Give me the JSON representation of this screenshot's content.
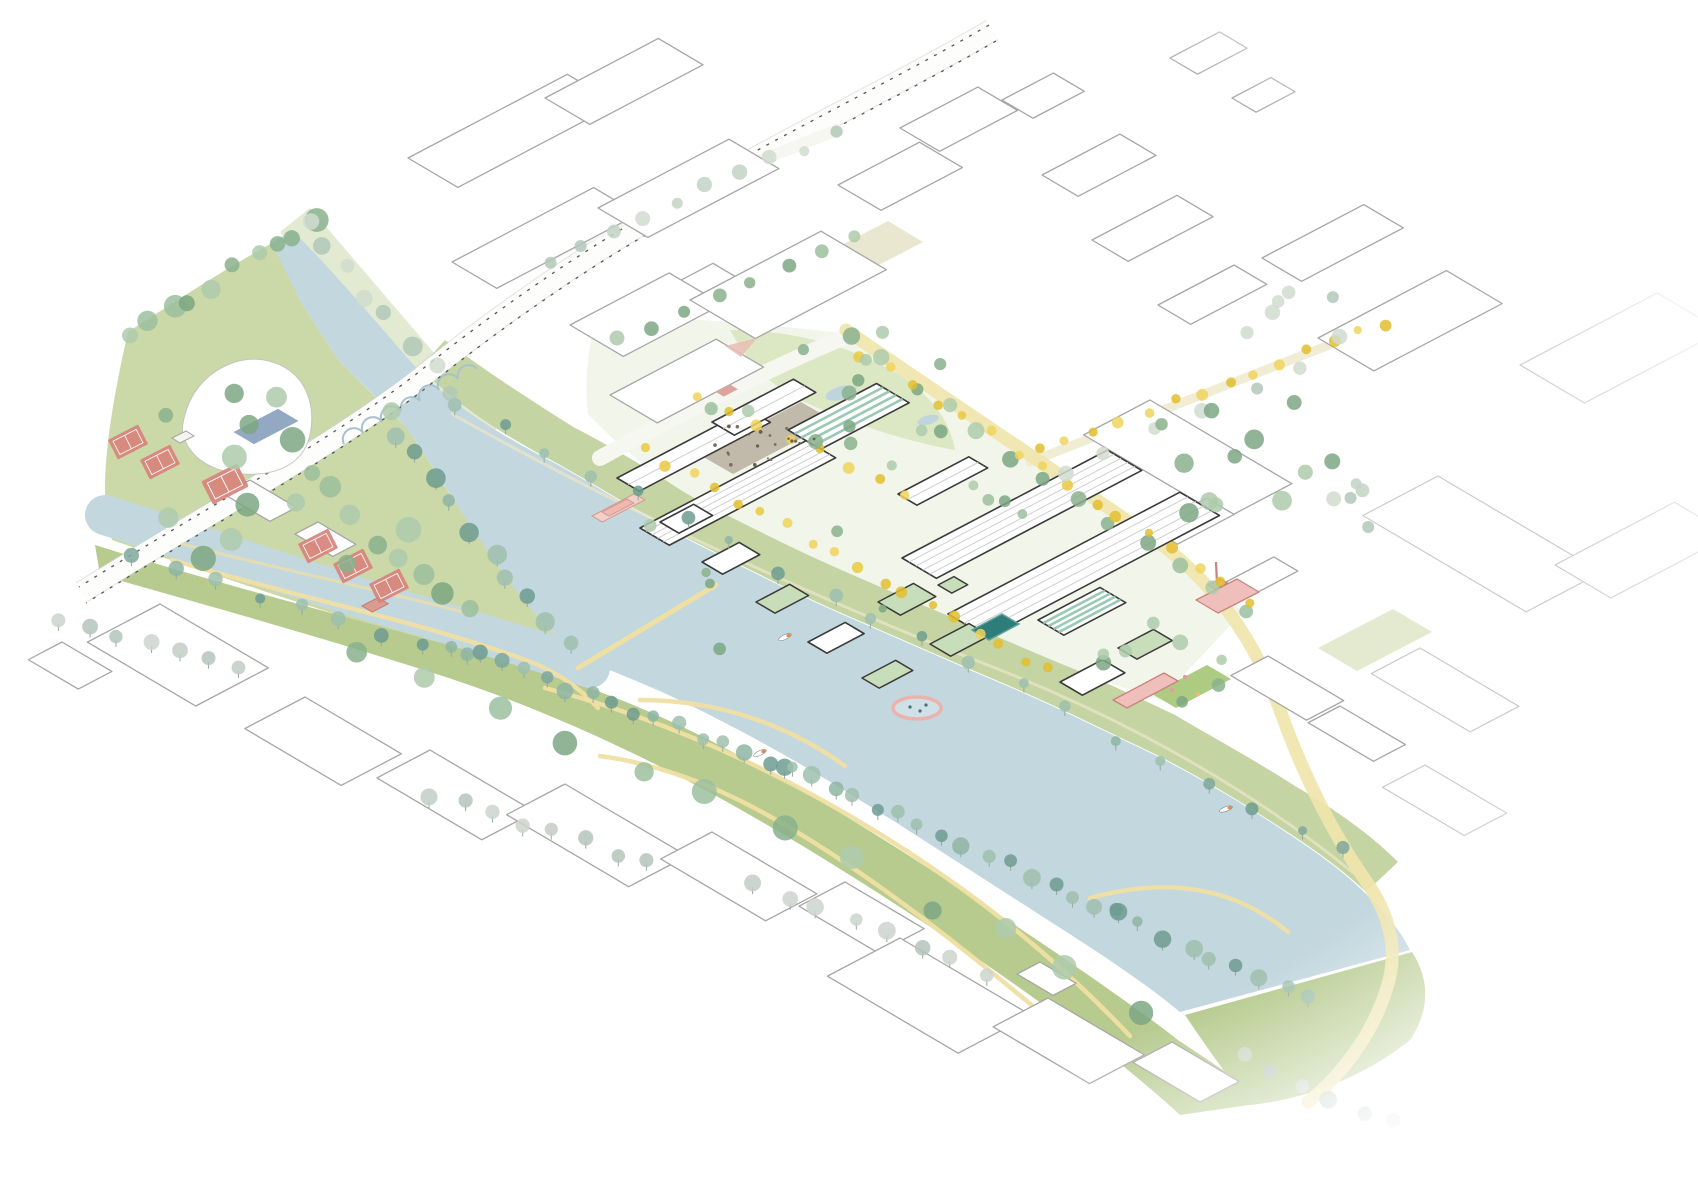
{
  "colors": {
    "river": "#C3D7DF",
    "parkGreen": "#B7CB8F",
    "parkPale": "#E3EAD2",
    "bankGreen": "#C4D4A2",
    "siteGround": "#F2F5E9",
    "northPark": "#DCE7C4",
    "lawn": "#E4EAD0",
    "field": "#E9E7CF",
    "playground": "#AECB82",
    "pathYellow": "#EFDFA3",
    "roadYellow": "#F0E5AC",
    "streetPale": "#F6F7F0",
    "courtRed": "#D8837B",
    "courtLine": "#FFFFFF",
    "pinkFill": "#EFC0BB",
    "pinkLine": "#C9837D",
    "redRoof": "#DC9B90",
    "pool": "#2E7D7A",
    "lidoPool": "#93A8C2",
    "plaza": "#B8AE9E",
    "outline": "#A6A6A6",
    "outlineFaded": "#CBCBCB",
    "siteOutline": "#3A3A3A",
    "roofGreen": "#C8DDB9",
    "ghStripe": "#8FC3AC",
    "railDash": "#555555",
    "railEdge": "#C7CFD2",
    "arcBlue": "#A9C2CE",
    "trunk": "#97A8A0",
    "swimRing": "#EBB3AC",
    "pondBlue": "#BFD5DD"
  },
  "scene": {
    "palettes": {
      "green": [
        "#9CBF9E",
        "#8AB18D",
        "#AECBAB",
        "#7CA783"
      ],
      "bank": [
        "#7FA79B",
        "#8FB5A5",
        "#9FC0AE",
        "#6E9C90"
      ],
      "gray": [
        "#C2CEC6",
        "#B4C4BB",
        "#CBD5CD"
      ],
      "pale": [
        "#C3D4C6",
        "#B2C8B8",
        "#D0DCCF"
      ],
      "yellow": [
        "#EAC93F",
        "#F0D45C",
        "#E3BE2F"
      ],
      "dots": [
        "#6B5F4E",
        "#7A6E5C"
      ]
    },
    "blocks": [
      [
        "c",
        408,
        158,
        180,
        58,
        0
      ],
      [
        "c",
        545,
        98,
        128,
        52,
        0
      ],
      [
        "c",
        452,
        262,
        160,
        52,
        0
      ],
      [
        "c",
        598,
        208,
        148,
        58,
        0
      ],
      [
        "c",
        628,
        308,
        96,
        44,
        0
      ],
      [
        "c",
        570,
        325,
        112,
        62,
        0
      ],
      [
        "c",
        690,
        300,
        148,
        76,
        0
      ],
      [
        "c",
        610,
        395,
        120,
        55,
        0
      ],
      [
        "c",
        838,
        185,
        92,
        50,
        0
      ],
      [
        "c",
        900,
        128,
        88,
        46,
        0
      ],
      [
        "c",
        1002,
        100,
        58,
        36,
        0
      ],
      [
        "c",
        1042,
        175,
        88,
        42,
        0
      ],
      [
        "c",
        1092,
        240,
        96,
        42,
        0
      ],
      [
        "c",
        1158,
        305,
        86,
        38,
        0
      ],
      [
        "c",
        1170,
        58,
        56,
        32,
        0
      ],
      [
        "c",
        1232,
        98,
        44,
        28,
        0
      ],
      [
        "c",
        1150,
        400,
        165,
        75,
        1
      ],
      [
        "c",
        1318,
        338,
        145,
        65,
        0
      ],
      [
        "c",
        1262,
        258,
        115,
        46,
        0
      ],
      [
        "c",
        1150,
        528,
        64,
        32,
        0
      ],
      [
        "c",
        1226,
        582,
        54,
        28,
        0
      ],
      [
        "c",
        1268,
        656,
        88,
        42,
        1
      ],
      [
        "c",
        1340,
        706,
        76,
        36,
        1
      ],
      [
        "c",
        250,
        480,
        54,
        30,
        1
      ],
      [
        "c",
        318,
        522,
        44,
        26,
        1
      ],
      [
        "c",
        160,
        604,
        126,
        82,
        1
      ],
      [
        "c",
        305,
        697,
        112,
        68,
        1
      ],
      [
        "c",
        430,
        750,
        122,
        60,
        1
      ],
      [
        "c",
        565,
        784,
        142,
        66,
        1
      ],
      [
        "c",
        712,
        832,
        122,
        58,
        1
      ],
      [
        "c",
        845,
        882,
        92,
        52,
        1
      ],
      [
        "c",
        900,
        938,
        152,
        82,
        1
      ],
      [
        "c",
        1048,
        998,
        112,
        62,
        1
      ],
      [
        "c",
        1040,
        962,
        42,
        26,
        1
      ],
      [
        "c",
        1172,
        1042,
        78,
        44,
        1
      ],
      [
        "c",
        62,
        642,
        58,
        38,
        1
      ],
      [
        "f",
        1438,
        476,
        190,
        85,
        1
      ],
      [
        "f",
        1520,
        365,
        155,
        75,
        0
      ],
      [
        "f",
        1555,
        565,
        135,
        65,
        0
      ],
      [
        "f",
        1420,
        648,
        115,
        55,
        1
      ],
      [
        "f",
        1425,
        765,
        95,
        48,
        1
      ],
      [
        "h",
        617,
        478,
        148,
        26,
        0
      ],
      [
        "s",
        640,
        528,
        188,
        34,
        0
      ],
      [
        "h",
        712,
        422,
        92,
        26,
        0
      ],
      [
        "g",
        788,
        430,
        100,
        38,
        0
      ],
      [
        "h",
        898,
        494,
        80,
        22,
        0
      ],
      [
        "s",
        948,
        614,
        262,
        46,
        0
      ],
      [
        "s",
        902,
        558,
        232,
        40,
        0
      ],
      [
        "g",
        1038,
        620,
        70,
        30,
        0
      ],
      [
        "rg",
        878,
        602,
        40,
        26,
        0
      ],
      [
        "rg",
        930,
        644,
        44,
        24,
        0
      ],
      [
        "s2",
        660,
        522,
        38,
        22,
        0
      ],
      [
        "s2",
        702,
        562,
        42,
        24,
        0
      ],
      [
        "rg",
        756,
        602,
        38,
        22,
        0
      ],
      [
        "s2",
        808,
        642,
        42,
        22,
        0
      ],
      [
        "rg",
        862,
        678,
        38,
        20,
        0
      ],
      [
        "rg",
        938,
        585,
        18,
        16,
        0
      ],
      [
        "s2",
        1060,
        682,
        48,
        26,
        0
      ],
      [
        "rg",
        1118,
        648,
        40,
        22,
        0
      ]
    ],
    "tree_rows": [
      [
        128,
        338,
        315,
        218,
        10,
        7,
        12,
        "green",
        16,
        0
      ],
      [
        305,
        225,
        452,
        388,
        8,
        6,
        10,
        "pale",
        14,
        0
      ],
      [
        398,
        432,
        566,
        646,
        10,
        6,
        10,
        "bank",
        12,
        1
      ],
      [
        350,
        520,
        468,
        608,
        6,
        8,
        12,
        "green",
        16,
        0
      ],
      [
        135,
        560,
        468,
        654,
        9,
        5,
        8,
        "bank",
        10,
        1
      ],
      [
        455,
        645,
        788,
        768,
        16,
        5,
        9,
        "bank",
        10,
        1
      ],
      [
        788,
        768,
        1118,
        913,
        16,
        5,
        9,
        "bank",
        10,
        1
      ],
      [
        1118,
        913,
        1308,
        1000,
        9,
        5,
        9,
        "bank",
        10,
        1
      ],
      [
        350,
        640,
        1150,
        1000,
        12,
        9,
        13,
        "green",
        26,
        0
      ],
      [
        62,
        618,
        235,
        668,
        7,
        6,
        9,
        "gray",
        10,
        1
      ],
      [
        430,
        792,
        645,
        862,
        8,
        6,
        9,
        "gray",
        10,
        1
      ],
      [
        752,
        882,
        985,
        972,
        8,
        6,
        9,
        "gray",
        10,
        1
      ],
      [
        1245,
        1060,
        1390,
        1125,
        6,
        6,
        9,
        "gray",
        12,
        0
      ],
      [
        452,
        400,
        1348,
        854,
        20,
        4,
        7,
        "bank",
        14,
        1
      ],
      [
        852,
        340,
        1242,
        612,
        13,
        6,
        9,
        "green",
        12,
        0
      ],
      [
        860,
        352,
        1248,
        600,
        16,
        4,
        6,
        "yellow",
        10,
        0
      ],
      [
        1040,
        452,
        1388,
        322,
        14,
        4,
        6,
        "yellow",
        8,
        0
      ],
      [
        1060,
        470,
        1300,
        372,
        6,
        5,
        8,
        "pale",
        12,
        0
      ],
      [
        548,
        258,
        836,
        134,
        10,
        5,
        8,
        "pale",
        10,
        0
      ],
      [
        622,
        338,
        852,
        238,
        8,
        5,
        8,
        "green",
        10,
        0
      ],
      [
        642,
        448,
        1048,
        672,
        18,
        4,
        6,
        "yellow",
        10,
        0
      ],
      [
        700,
        398,
        906,
        492,
        8,
        4,
        6,
        "yellow",
        8,
        0
      ]
    ],
    "tree_scatters": [
      [
        150,
        360,
        260,
        210,
        16,
        7,
        13,
        "green"
      ],
      [
        650,
        400,
        440,
        250,
        14,
        4,
        7,
        "green"
      ],
      [
        732,
        322,
        210,
        120,
        10,
        5,
        8,
        "green"
      ],
      [
        1080,
        620,
        150,
        100,
        8,
        5,
        8,
        "green"
      ],
      [
        1150,
        390,
        190,
        130,
        12,
        6,
        10,
        "green"
      ],
      [
        1240,
        280,
        100,
        70,
        6,
        5,
        8,
        "pale"
      ],
      [
        1300,
        430,
        90,
        100,
        5,
        5,
        8,
        "pale"
      ],
      [
        715,
        425,
        100,
        40,
        20,
        1,
        2,
        "dots"
      ]
    ],
    "courts": [
      [
        128,
        442,
        1
      ],
      [
        160,
        462,
        1
      ],
      [
        225,
        484,
        1.18
      ],
      [
        318,
        546,
        1
      ],
      [
        353,
        566,
        1
      ],
      [
        389,
        586,
        1
      ]
    ],
    "boats": [
      [
        785,
        637,
        -25
      ],
      [
        760,
        753,
        -25
      ],
      [
        1226,
        809,
        -20
      ]
    ],
    "ponds": [
      [
        841,
        393,
        16,
        6.5
      ],
      [
        928,
        420,
        11,
        4.5
      ]
    ],
    "swim_ring": {
      "cx": 917,
      "cy": 708,
      "rx": 24,
      "ry": 11
    }
  }
}
